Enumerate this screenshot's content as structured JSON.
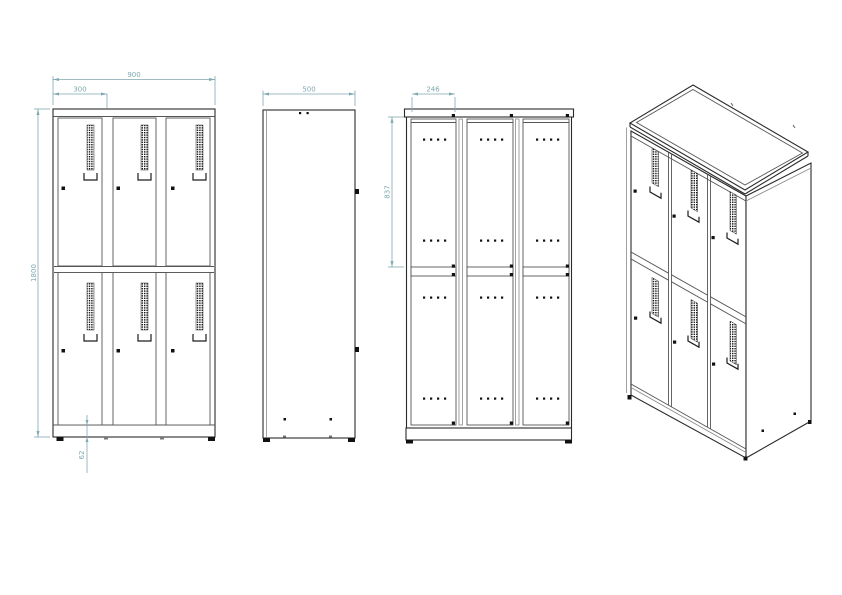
{
  "page": {
    "background": "#ffffff"
  },
  "colors": {
    "line": "#2a2a2a",
    "line_medium": "#555555",
    "dimension": "#7fa8b0"
  },
  "dimensions": {
    "front_width": "900",
    "front_column_width": "300",
    "front_height": "1800",
    "front_base_height": "62",
    "side_depth": "500",
    "rear_door_width": "246",
    "rear_door_height": "837"
  }
}
